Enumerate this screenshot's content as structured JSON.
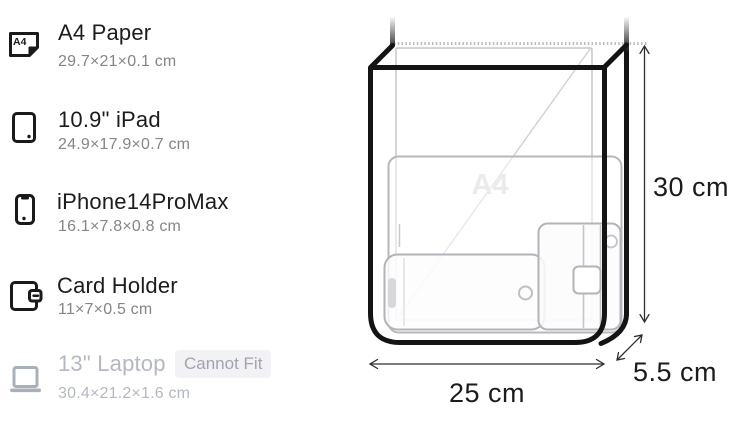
{
  "items": [
    {
      "name": "A4 Paper",
      "dims": "29.7×21×0.1 cm",
      "icon": "a4-paper-icon",
      "fits": true,
      "icon_label": "A4"
    },
    {
      "name": "10.9\" iPad",
      "dims": "24.9×17.9×0.7 cm",
      "icon": "ipad-icon",
      "fits": true
    },
    {
      "name": "iPhone14ProMax",
      "dims": "16.1×7.8×0.8 cm",
      "icon": "iphone-icon",
      "fits": true
    },
    {
      "name": "Card Holder",
      "dims": "11×7×0.5 cm",
      "icon": "card-holder-icon",
      "fits": true
    },
    {
      "name": "13\" Laptop",
      "dims": "30.4×21.2×1.6 cm",
      "icon": "laptop-icon",
      "fits": false,
      "badge": "Cannot Fit"
    }
  ],
  "diagram": {
    "height_label": "30 cm",
    "width_label": "25 cm",
    "depth_label": "5.5 cm",
    "a4_watermark": "A4"
  },
  "colors": {
    "title": "#1c1c1e",
    "subtitle": "#85858a",
    "disabled": "#b4b8c2",
    "badge_bg": "#f2f2f5",
    "badge_text": "#a0a4ae",
    "bag_outline": "#141414",
    "item_outline": "#b3b3b9",
    "dim_text": "#1b1b1d"
  }
}
